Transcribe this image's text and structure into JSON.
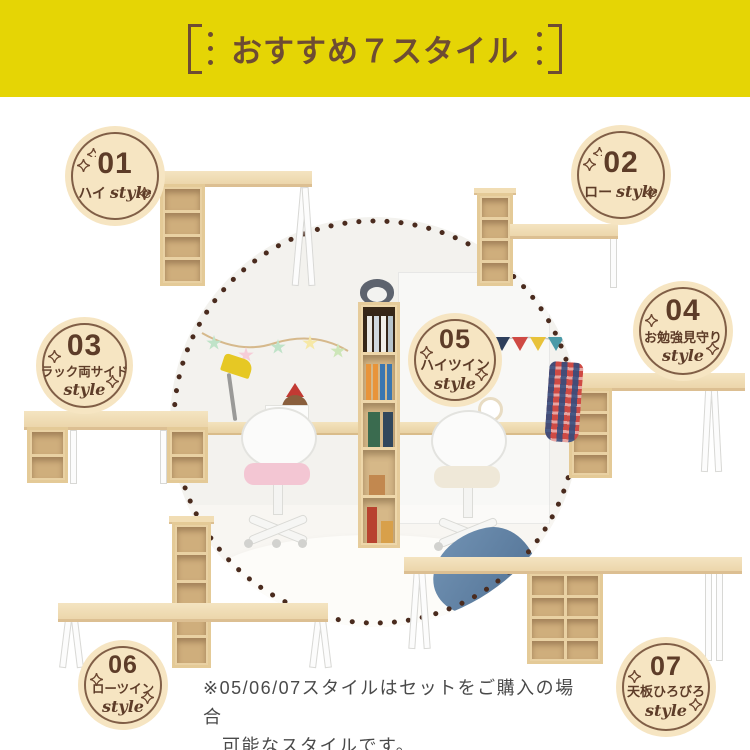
{
  "header": {
    "title": "おすすめ７スタイル"
  },
  "badges": [
    {
      "num": "01",
      "label": "ハイ",
      "style_word": "style"
    },
    {
      "num": "02",
      "label": "ロー",
      "style_word": "style"
    },
    {
      "num": "03",
      "label": "ラック両サイド",
      "style_word": "style"
    },
    {
      "num": "04",
      "label": "お勉強見守り",
      "style_word": "style"
    },
    {
      "num": "05",
      "label": "ハイツイン",
      "style_word": "style"
    },
    {
      "num": "06",
      "label": "ローツイン",
      "style_word": "style"
    },
    {
      "num": "07",
      "label": "天板ひろびろ",
      "style_word": "style"
    }
  ],
  "note": {
    "line1": "※05/06/07スタイルはセットをご購入の場合",
    "line2": "可能なスタイルです。"
  },
  "colors": {
    "header_bg": "#e5d505",
    "header_text": "#6e4c33",
    "badge_bg": "#f6e5c2",
    "badge_text": "#5d3c28",
    "dot_ring": "#4a2b1e",
    "wood": "#ecd6ab",
    "note_text": "#4a4a4a"
  }
}
